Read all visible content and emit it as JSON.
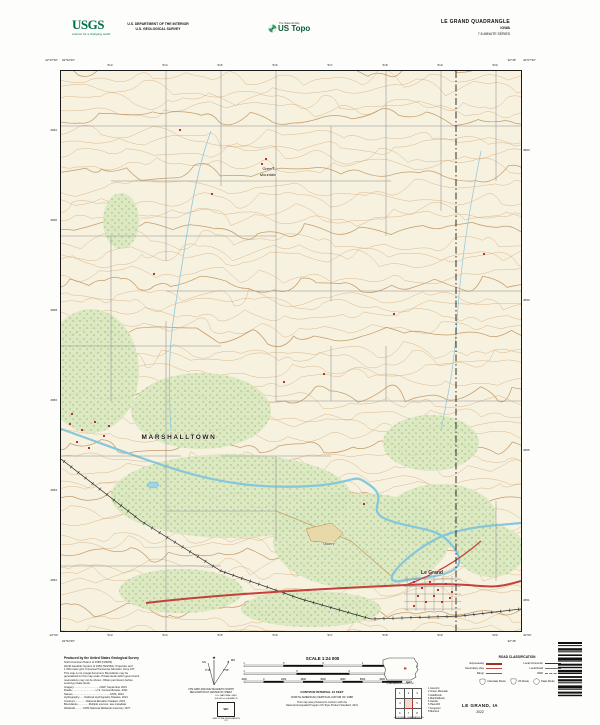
{
  "header": {
    "usgs_logo_text": "USGS",
    "usgs_tagline": "science for a changing world",
    "dept_line1": "U.S. DEPARTMENT OF THE INTERIOR",
    "dept_line2": "U.S. GEOLOGICAL SURVEY",
    "ustopo_overline": "The National Map",
    "ustopo_brand": "US Topo",
    "title_line1": "LE GRAND QUADRANGLE",
    "title_line2": "IOWA",
    "title_line3": "7.5-MINUTE SERIES"
  },
  "map": {
    "corner_labels": {
      "tl_lat": "42°07′30″",
      "tl_lon": "92°52′30″",
      "tr_lat": "42°07′30″",
      "tr_lon": "92°45′",
      "bl_lat": "42°00′",
      "bl_lon": "92°52′30″",
      "br_lat": "42°00′",
      "br_lon": "92°45′"
    },
    "top_ticks": [
      "513",
      "514",
      "515",
      "516",
      "517",
      "518",
      "519",
      "520"
    ],
    "bottom_ticks": [
      "513",
      "514",
      "515",
      "516",
      "517",
      "518",
      "519",
      "520"
    ],
    "left_ticks": [
      "4662",
      "4660",
      "4658",
      "4656",
      "4654",
      "4652"
    ],
    "right_ticks": [
      "4663",
      "4659",
      "4655",
      "4651"
    ],
    "place_labels": [
      {
        "text": "MARSHALLTOWN",
        "x": 118,
        "y": 368,
        "cls": "city"
      },
      {
        "text": "Green",
        "x": 207,
        "y": 99,
        "cls": "place"
      },
      {
        "text": "Mountain",
        "x": 207,
        "y": 105,
        "cls": "place"
      },
      {
        "text": "Quarry",
        "x": 268,
        "y": 474,
        "cls": "feat"
      },
      {
        "text": "Le Grand",
        "x": 371,
        "y": 503,
        "cls": "town"
      }
    ]
  },
  "footer": {
    "produced_by": "Produced by the United States Geological Survey",
    "credits": [
      "North American Datum of 1983 (NAD83)",
      "World Geodetic System of 1984 (WGS84). Projection and",
      "1 000-meter grid: Universal Transverse Mercator, Zone 15T",
      "This map is not a legal document. Boundaries may be",
      "generalized for this map scale. Private lands within government",
      "reservations may not be shown. Obtain permission before",
      "entering private lands.",
      "Imagery...................................NAIP, September 2021",
      "Roads................................U.S. Census Bureau, 2021",
      "Names..................................................GNIS, 2021",
      "Hydrography.......National Hydrography Dataset, 2021",
      "Contours...............National Elevation Dataset, 2021",
      "Boundaries...............Multiple sources; see metadata",
      "Wetlands...........FWS National Wetlands Inventory 1977"
    ],
    "declination": {
      "star": "★",
      "gn_label": "GN",
      "gn_value": "0°16′",
      "mn_label": "MN",
      "mn_value": "2°05′",
      "caption1": "UTM GRID AND 2022 MAGNETIC NORTH",
      "caption2": "DECLINATION AT CENTER OF SHEET"
    },
    "usng": {
      "line1": "U.S. NATIONAL GRID",
      "line2": "100,000-m SQUARE ID",
      "square_id": "WC",
      "zone_caption": "GRID ZONE DESIGNATION",
      "zone": "15T"
    },
    "scale": {
      "title": "SCALE 1:24 000",
      "bars": [
        {
          "unit": "KILOMETERS",
          "ticks": [
            "1",
            ".5",
            "0",
            "1",
            "2"
          ]
        },
        {
          "unit": "MILES",
          "ticks": [
            "1",
            ".5",
            "0",
            "1"
          ]
        },
        {
          "unit": "FEET",
          "ticks": [
            "1000",
            "0",
            "1000",
            "2000",
            "3000",
            "4000",
            "5000",
            "6000",
            "7000"
          ]
        }
      ]
    },
    "contour_line": "CONTOUR INTERVAL 10 FEET",
    "datum_line": "NORTH AMERICAN VERTICAL DATUM OF 1988",
    "conform_line1": "This map was produced to conform with the",
    "conform_line2": "National Geospatial Program US Topo Product Standard, 2011",
    "state_outline_caption": "QUADRANGLE LOCATION",
    "adjoining": {
      "caption": "ADJOINING QUADRANGLES",
      "grid_numbers": [
        "1",
        "2",
        "3",
        "4",
        "5",
        "6",
        "7",
        "8"
      ],
      "names": [
        "Liscomb",
        "Green Mountain",
        "Gladbrook",
        "Marshalltown",
        "Garwin",
        "Haverhill",
        "Ferguson",
        "Montour"
      ]
    },
    "road_classification": {
      "title": "ROAD CLASSIFICATION",
      "rows": [
        {
          "sample": "expressway",
          "label": "Expressway"
        },
        {
          "sample": "secondary",
          "label": "Secondary Hwy"
        },
        {
          "sample": "ramp",
          "label": "Ramp"
        },
        {
          "sample": "connector",
          "label": "Local Connector"
        },
        {
          "sample": "local",
          "label": "Local Road"
        },
        {
          "sample": "fourwd",
          "label": "4WD"
        }
      ],
      "shields": [
        {
          "type": "interstate",
          "label": "Interstate Route"
        },
        {
          "type": "us",
          "label": "US Route"
        },
        {
          "type": "state",
          "label": "State Route"
        }
      ]
    },
    "sheet_name": "LE GRAND, IA",
    "sheet_year": "2022"
  }
}
